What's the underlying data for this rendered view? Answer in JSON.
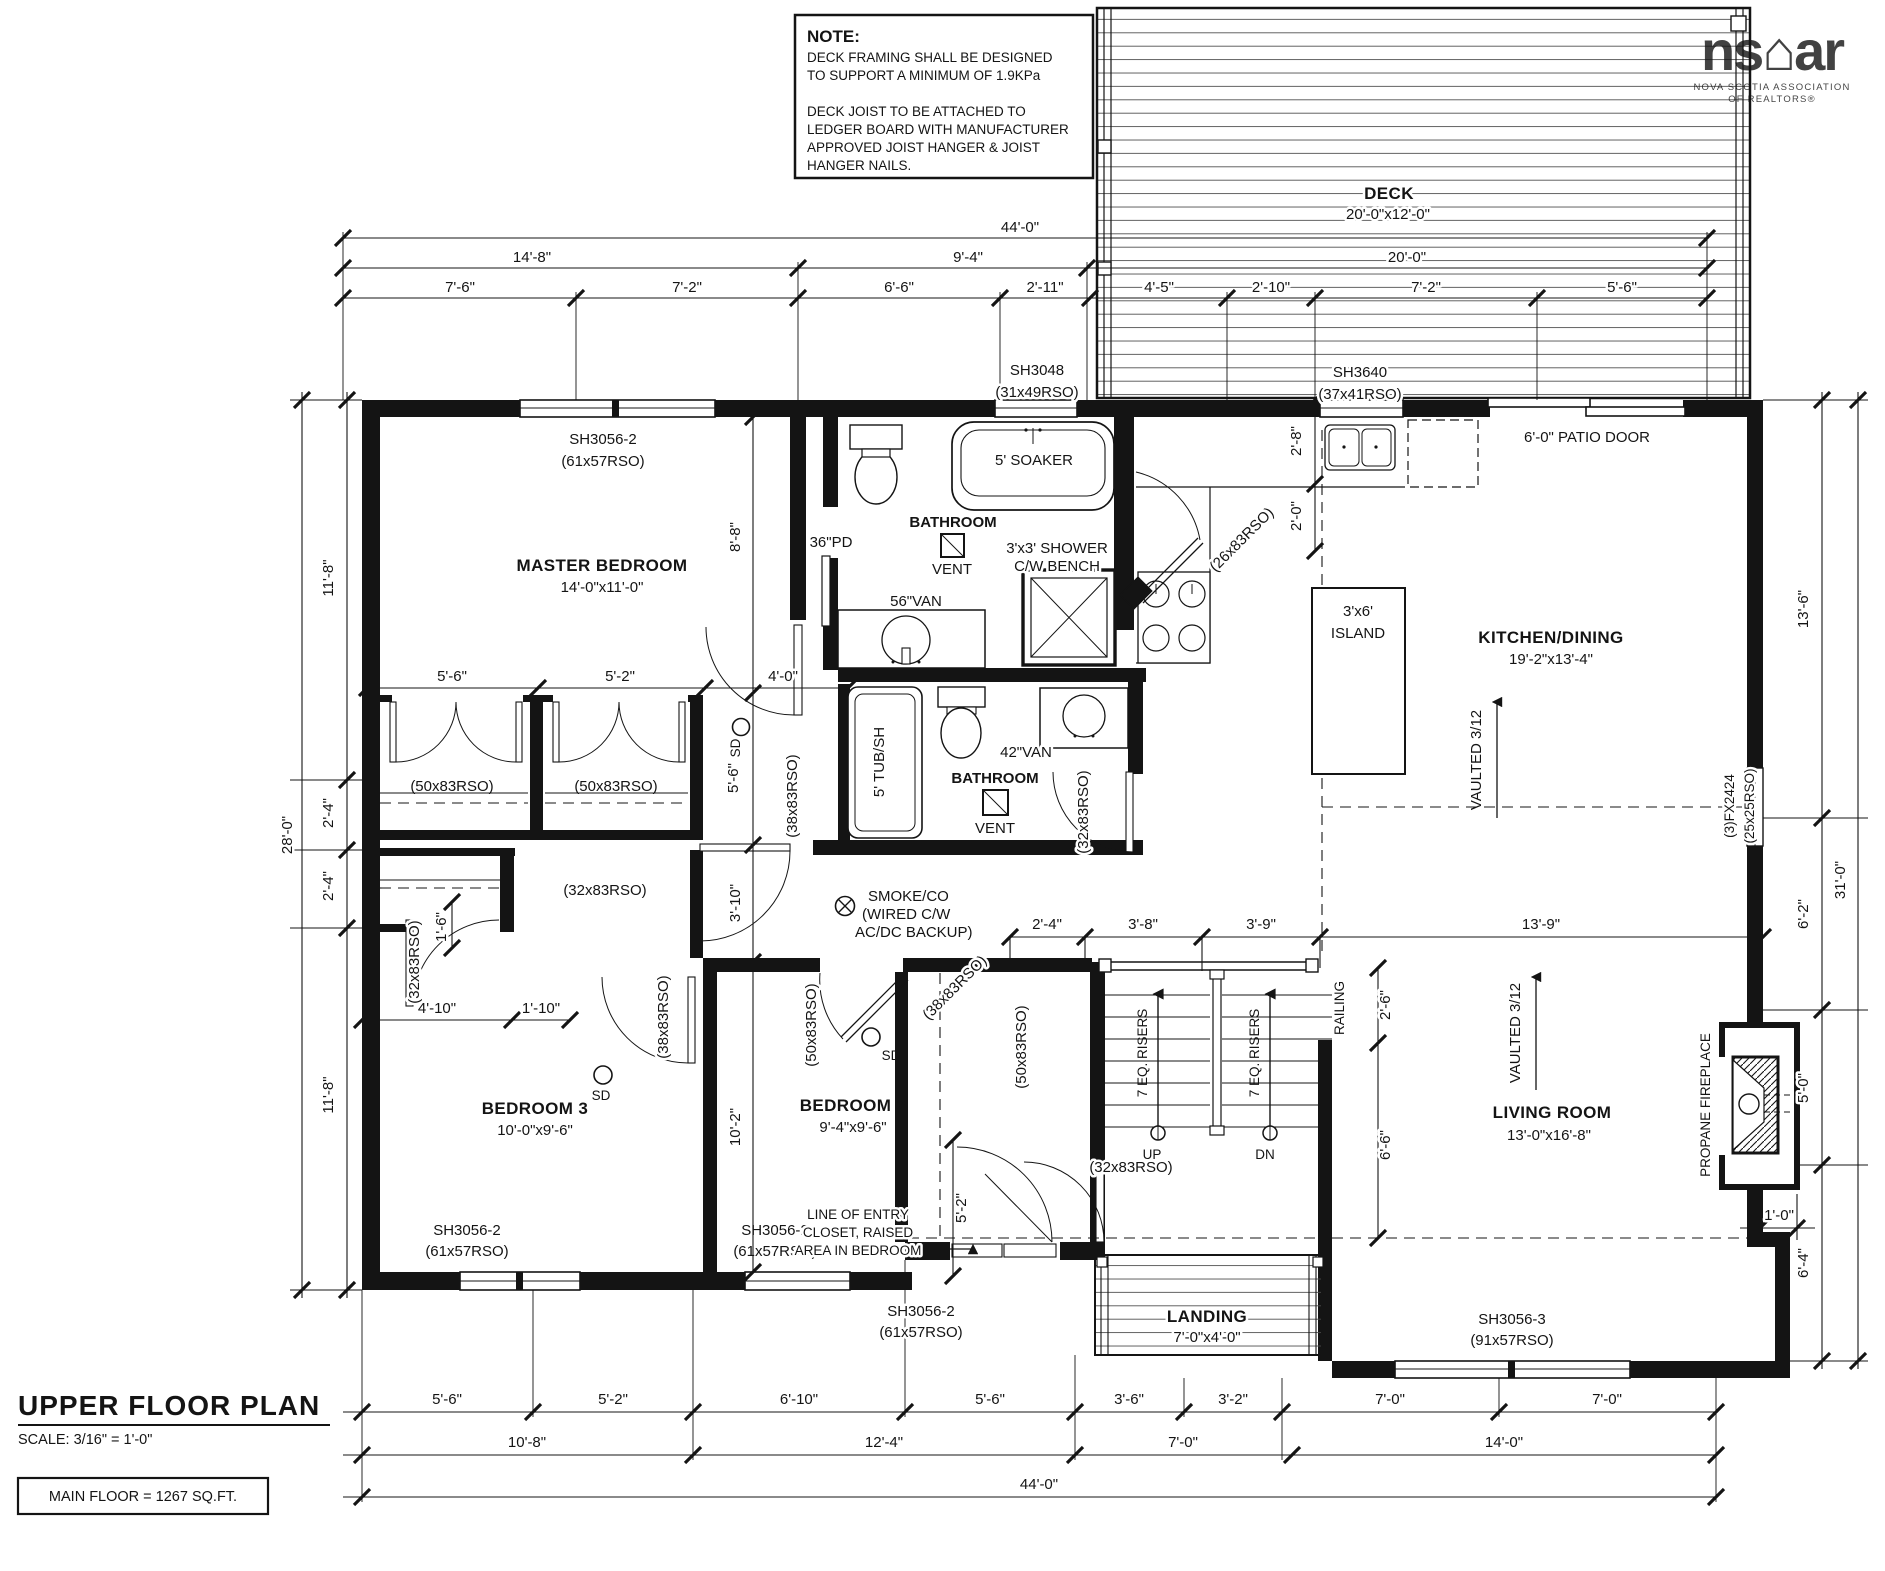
{
  "note": {
    "title": "NOTE:",
    "l1": "DECK FRAMING SHALL BE DESIGNED",
    "l2": "TO SUPPORT A MINIMUM OF 1.9KPa",
    "l3": "DECK JOIST TO BE ATTACHED TO",
    "l4": "LEDGER BOARD WITH MANUFACTURER",
    "l5": "APPROVED JOIST HANGER & JOIST",
    "l6": "HANGER NAILS."
  },
  "logo": {
    "mark": "ns⌂ar",
    "sub1": "NOVA SCOTIA ASSOCIATION",
    "sub2": "OF REALTORS®"
  },
  "title_block": {
    "title": "UPPER FLOOR PLAN",
    "scale": "SCALE: 3/16\" = 1'-0\"",
    "area": "MAIN FLOOR = 1267 SQ.FT."
  },
  "rooms": {
    "deck": {
      "name": "DECK",
      "size": "20'-0\"x12'-0\""
    },
    "master": {
      "name": "MASTER BEDROOM",
      "size": "14'-0\"x11'-0\""
    },
    "kitchen": {
      "name": "KITCHEN/DINING",
      "size": "19'-2\"x13'-4\""
    },
    "living": {
      "name": "LIVING ROOM",
      "size": "13'-0\"x16'-8\""
    },
    "bed2": {
      "name": "BEDROOM 2",
      "size": "9'-4\"x9'-6\""
    },
    "bed3": {
      "name": "BEDROOM 3",
      "size": "10'-0\"x9'-6\""
    },
    "landing": {
      "name": "LANDING",
      "size": "7'-0\"x4'-0\""
    },
    "bath": "BATHROOM"
  },
  "win": {
    "sh3056_2": {
      "a": "SH3056-2",
      "b": "(61x57RSO)"
    },
    "sh3048": {
      "a": "SH3048",
      "b": "(31x49RSO)"
    },
    "sh3640": {
      "a": "SH3640",
      "b": "(37x41RSO)"
    },
    "sh3056_3": {
      "a": "SH3056-3",
      "b": "(91x57RSO)"
    },
    "fx": {
      "a": "(3)FX2424",
      "b": "(25x25RSO)"
    },
    "patio": "6'-0\" PATIO DOOR"
  },
  "door": {
    "r50": "(50x83RSO)",
    "r32": "(32x83RSO)",
    "r38": "(38x83RSO)",
    "r26": "(26x83RSO)",
    "pd": "36\"PD"
  },
  "fix": {
    "soaker": "5' SOAKER",
    "tub": "5' TUB/SH",
    "shower_a": "3'x3' SHOWER",
    "shower_b": "C/W BENCH",
    "van56": "56\"VAN",
    "van42": "42\"VAN",
    "vent": "VENT",
    "island_a": "3'x6'",
    "island_b": "ISLAND"
  },
  "ann": {
    "smoke_a": "SMOKE/CO",
    "smoke_b": "(WIRED C/W",
    "smoke_c": "AC/DC BACKUP)",
    "sd": "SD",
    "vaulted": "VAULTED 3/12",
    "railing": "RAILING",
    "risers": "7 EQ. RISERS",
    "up": "UP",
    "dn": "DN",
    "entry_a": "LINE OF ENTRY",
    "entry_b": "CLOSET, RAISED",
    "entry_c": "AREA IN BEDROOM",
    "fireplace": "PROPANE FIREPLACE"
  },
  "dims": {
    "top1": "44'-0\"",
    "top2": [
      "14'-8\"",
      "9'-4\"",
      "20'-0\""
    ],
    "top3": [
      "7'-6\"",
      "7'-2\"",
      "6'-6\"",
      "2'-11\"",
      "4'-5\"",
      "2'-10\"",
      "7'-2\"",
      "5'-6\""
    ],
    "left": [
      "11'-8\"",
      "2'-4\"",
      "2'-4\"",
      "11'-8\""
    ],
    "left_total": "28'-0\"",
    "right": [
      "13'-6\"",
      "6'-2\"",
      "5'-0\"",
      "6'-4\""
    ],
    "right_total": "31'-0\"",
    "jog": "1'-0\"",
    "stair": [
      "2'-4\"",
      "3'-8\"",
      "3'-9\"",
      "13'-9\""
    ],
    "bottom1": [
      "5'-6\"",
      "5'-2\"",
      "6'-10\"",
      "5'-6\"",
      "3'-6\"",
      "3'-2\"",
      "7'-0\"",
      "7'-0\""
    ],
    "bottom2": [
      "10'-8\"",
      "12'-4\"",
      "7'-0\"",
      "14'-0\""
    ],
    "bottom3": "44'-0\"",
    "closet": [
      "5'-6\"",
      "5'-2\"",
      "4'-0\""
    ],
    "i8_8": "8'-8\"",
    "i5_6": "5'-6\"",
    "i3_10": "3'-10\"",
    "i10_2": "10'-2\"",
    "i2_8": "2'-8\"",
    "i2_0": "2'-0\"",
    "i2_6": "2'-6\"",
    "i6_6": "6'-6\"",
    "e5_2": "5'-2\"",
    "b4_10": "4'-10\"",
    "b1_10": "1'-10\"",
    "c1_6": "1'-6\""
  }
}
